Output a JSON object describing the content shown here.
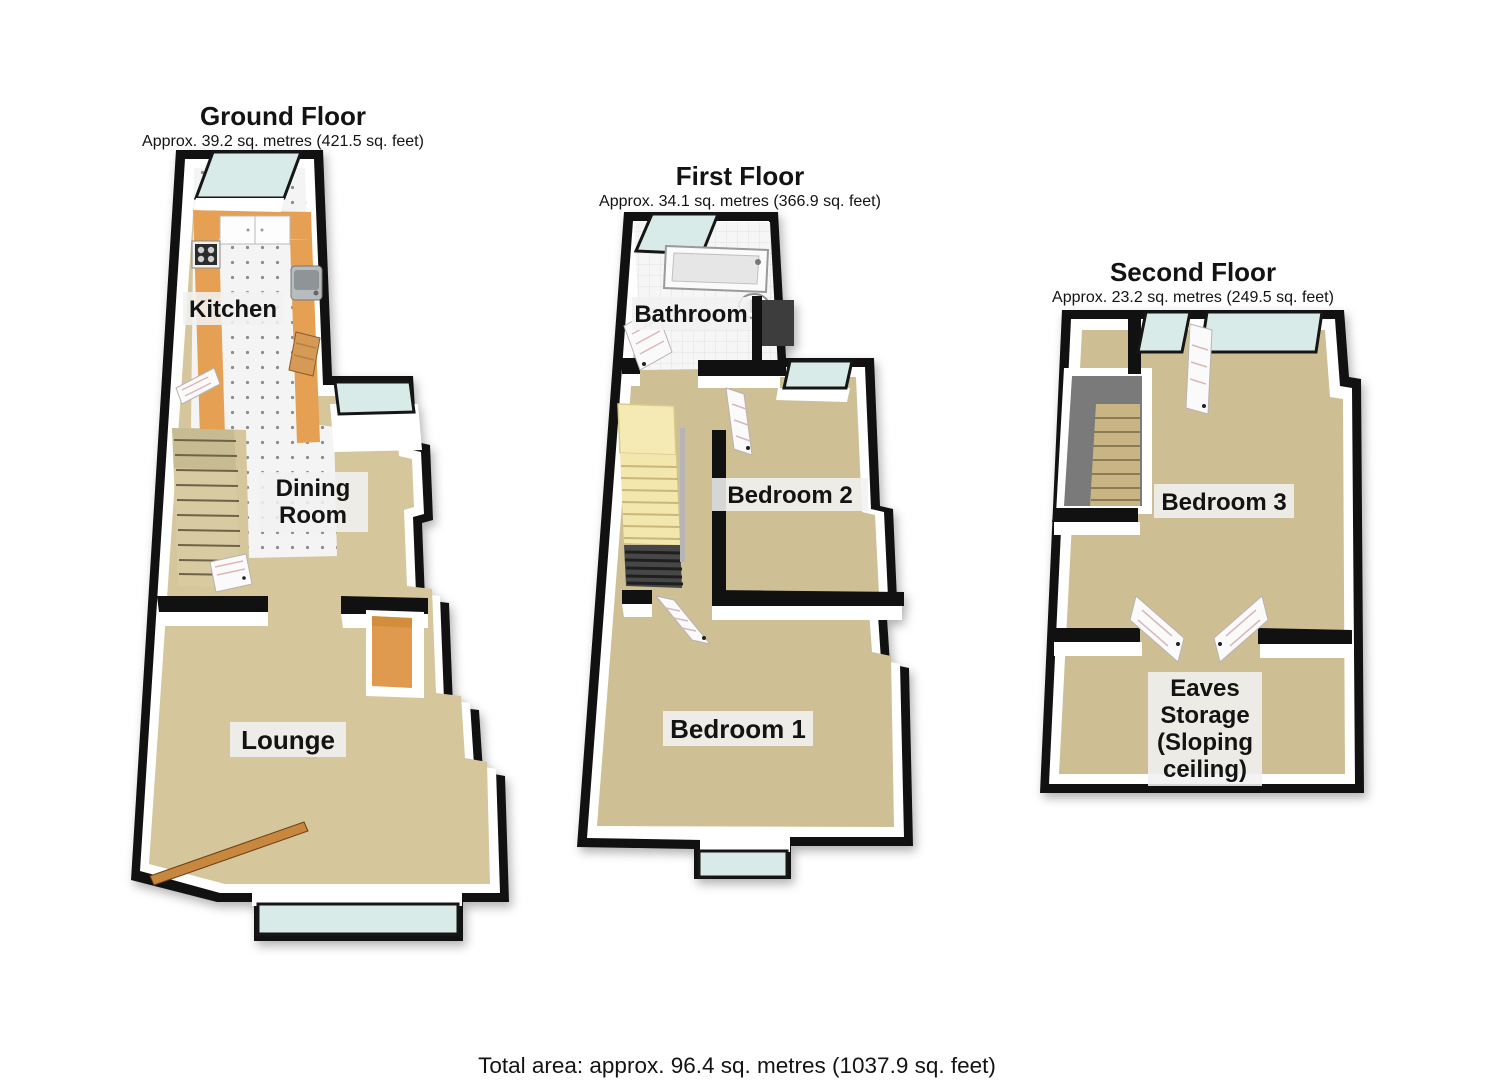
{
  "ground_floor": {
    "title": "Ground Floor",
    "area": "Approx. 39.2 sq. metres (421.5 sq. feet)",
    "rooms": {
      "kitchen": "Kitchen",
      "dining_line1": "Dining",
      "dining_line2": "Room",
      "lounge": "Lounge"
    }
  },
  "first_floor": {
    "title": "First Floor",
    "area": "Approx. 34.1 sq. metres (366.9 sq. feet)",
    "rooms": {
      "bathroom": "Bathroom",
      "bedroom2": "Bedroom 2",
      "bedroom1": "Bedroom 1"
    }
  },
  "second_floor": {
    "title": "Second Floor",
    "area": "Approx. 23.2 sq. metres (249.5 sq. feet)",
    "rooms": {
      "bedroom3": "Bedroom 3",
      "eaves_line1": "Eaves",
      "eaves_line2": "Storage",
      "eaves_line3": "(Sloping",
      "eaves_line4": "ceiling)"
    }
  },
  "footer": {
    "total_area": "Total area: approx. 96.4 sq. metres (1037.9 sq. feet)"
  },
  "colors": {
    "wall": "#111111",
    "carpet_ground": "#d5c69c",
    "carpet_first": "#cec094",
    "carpet_second": "#cdbf93",
    "window_glass": "#d9ebe9",
    "kitchen_counter": "#e5a054",
    "fireplace": "#e09a50",
    "stairs_ground": "#d8caa1",
    "stairs_first": "#f3e7ae",
    "stairs_second": "#c9b583",
    "stair_void_dark": "#474747",
    "stairwell_gray": "#7a7a7a",
    "wood_door": "#c8873f",
    "label_background": "#f1f1f1",
    "text": "#131313"
  }
}
